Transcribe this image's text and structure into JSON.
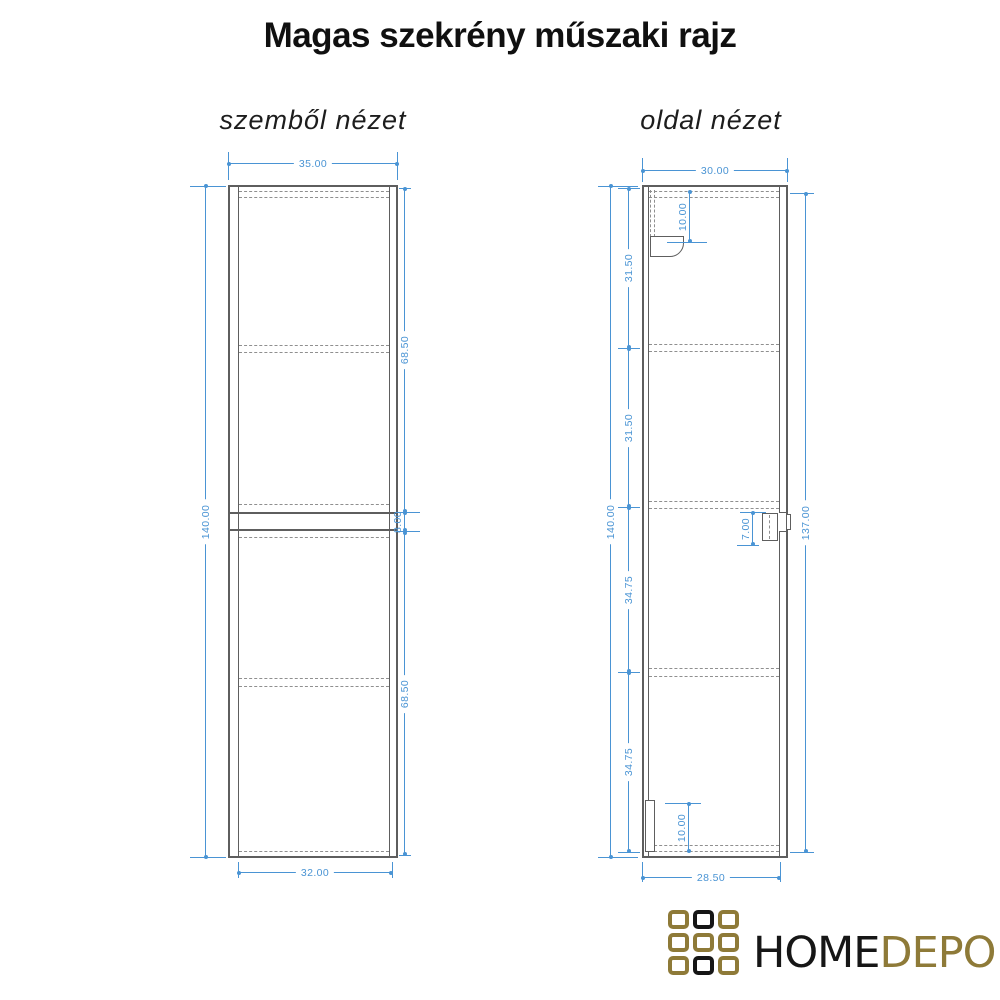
{
  "title": "Magas szekrény műszaki rajz",
  "front_view": {
    "label": "szemből nézet",
    "dims": {
      "top": "35.00",
      "bottom": "32.00",
      "height": "140.00",
      "door_top": "68.50",
      "gap": "8.00",
      "door_bottom": "68.50"
    }
  },
  "side_view": {
    "label": "oldal nézet",
    "dims": {
      "top": "30.00",
      "bottom": "28.50",
      "height": "140.00",
      "seg1": "31.50",
      "seg2": "31.50",
      "seg3": "34.75",
      "seg4": "34.75",
      "door": "137.00",
      "bracket_top": "10.00",
      "bracket_mid": "7.00",
      "bracket_bottom": "10.00"
    }
  },
  "logo": {
    "word1": "HOME",
    "word2": "DEPO",
    "grid": [
      "gold",
      "black",
      "gold",
      "gold",
      "gold",
      "gold",
      "gold",
      "black",
      "gold"
    ]
  },
  "colors": {
    "dimension": "#4a94d4",
    "drawing_line": "#5e5e5e",
    "hidden_line": "#8f8f8f",
    "logo_gold": "#8e7a38",
    "logo_black": "#161616",
    "text": "#101010"
  }
}
